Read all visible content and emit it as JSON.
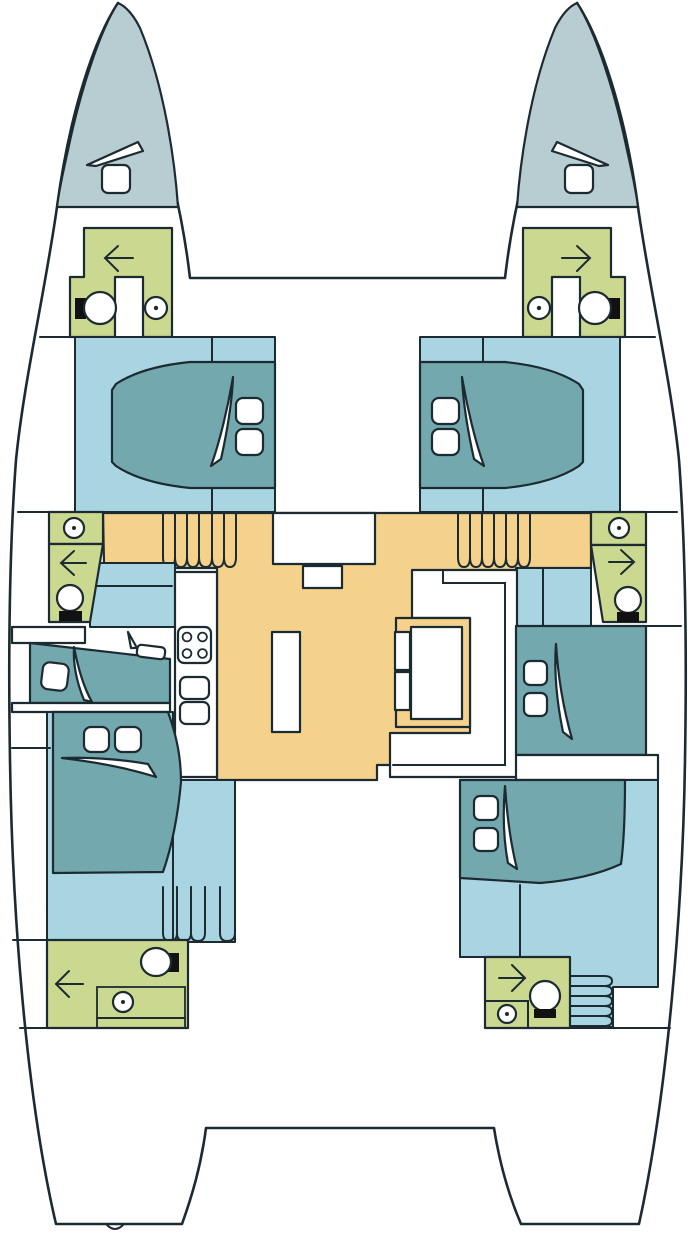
{
  "title": "catamaran-deck-plan",
  "colors": {
    "outline": "#1c2a31",
    "bow": "#b8cdd1",
    "cabin": "#a9d5e3",
    "bed": "#72a8ae",
    "bath": "#cbd890",
    "salon": "#f4d28c",
    "fixture": "#111111",
    "deck": "#ffffff"
  },
  "vessel": {
    "type": "catamaran",
    "hulls": [
      "port",
      "starboard"
    ],
    "rooms": [
      "port-bow-locker",
      "starboard-bow-locker",
      "port-forward-head",
      "starboard-forward-head",
      "port-forward-cabin",
      "starboard-forward-cabin",
      "port-mid-shower",
      "starboard-mid-shower",
      "port-mid-berth",
      "starboard-mid-cabin",
      "port-aft-cabin",
      "starboard-aft-cabin",
      "port-aft-head",
      "starboard-aft-head",
      "salon-galley-dinette",
      "aft-deck"
    ],
    "fixtures": {
      "double_beds": 5,
      "single_berths": 1,
      "toilets": 3,
      "showers": 3,
      "sinks": 6,
      "stoves": 1,
      "stair_runs": 4,
      "deck_hatches": 2,
      "door_arrows": 6,
      "tables": 2
    }
  }
}
